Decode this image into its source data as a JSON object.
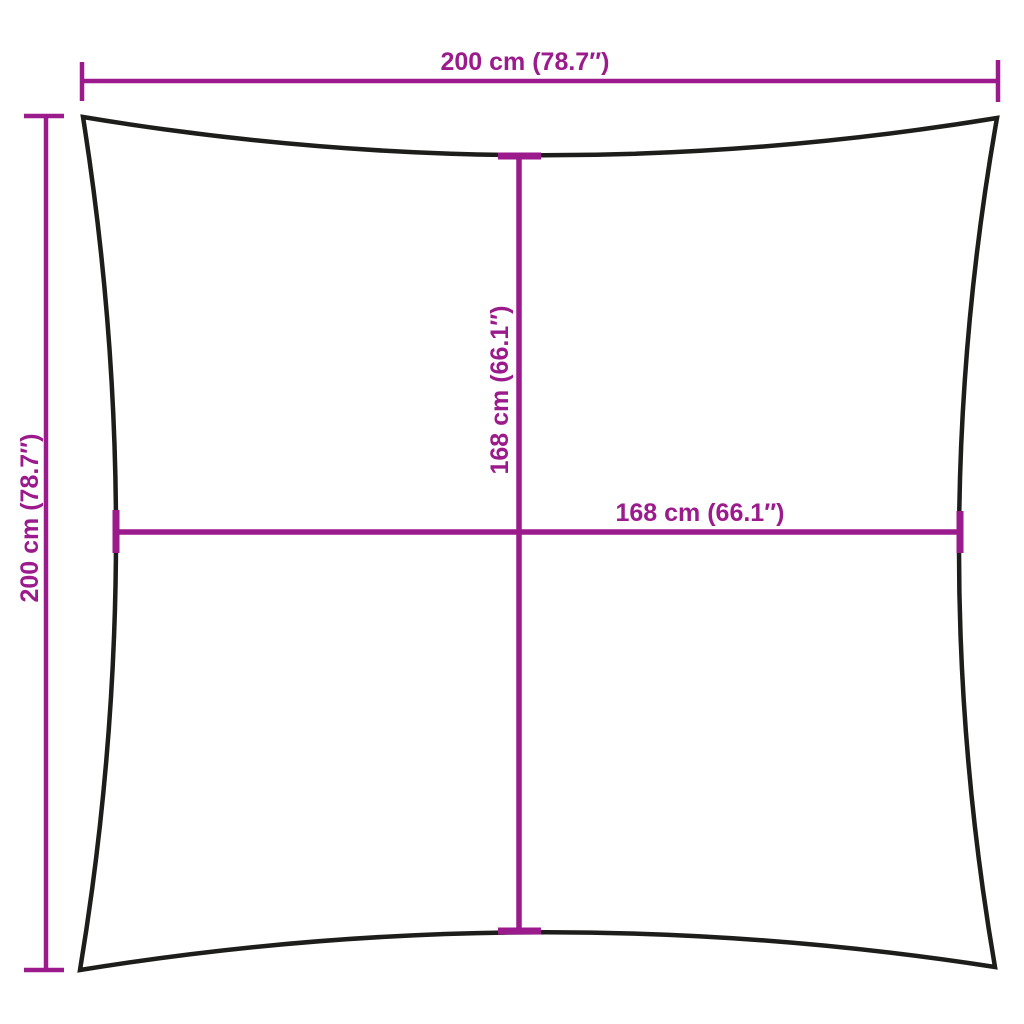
{
  "diagram": {
    "kind": "product-dimension-diagram",
    "labels": {
      "top_width": "200 cm (78.7″)",
      "left_height": "200 cm (78.7″)",
      "inner_height": "168 cm (66.1″)",
      "inner_width": "168 cm (66.1″)"
    },
    "colors": {
      "dimension_accent": "#9b1a8c",
      "shape_outline": "#1d1d1b",
      "background": "#ffffff"
    }
  }
}
